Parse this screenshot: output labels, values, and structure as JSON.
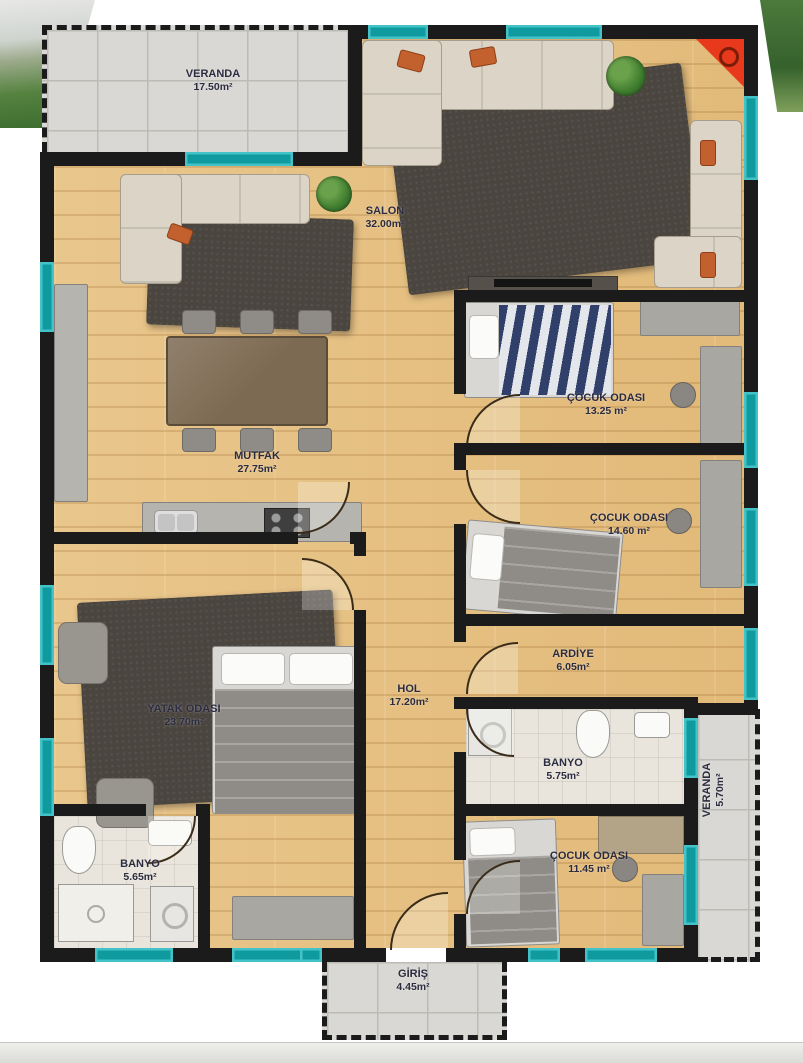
{
  "plan": {
    "rooms": [
      {
        "id": "veranda_top",
        "name": "VERANDA",
        "area": "17.50m²"
      },
      {
        "id": "salon",
        "name": "SALON",
        "area": "32.00m²"
      },
      {
        "id": "mutfak",
        "name": "MUTFAK",
        "area": "27.75m²"
      },
      {
        "id": "cocuk_odasi_1",
        "name": "ÇOCUK ODASI",
        "area": "13.25 m²"
      },
      {
        "id": "cocuk_odasi_2",
        "name": "ÇOCUK ODASI",
        "area": "14.60 m²"
      },
      {
        "id": "ardiye",
        "name": "ARDİYE",
        "area": "6.05m²"
      },
      {
        "id": "hol",
        "name": "HOL",
        "area": "17.20m²"
      },
      {
        "id": "yatak_odasi",
        "name": "YATAK ODASI",
        "area": "23.70m²"
      },
      {
        "id": "banyo_1",
        "name": "BANYO",
        "area": "5.65m²"
      },
      {
        "id": "banyo_2",
        "name": "BANYO",
        "area": "5.75m²"
      },
      {
        "id": "cocuk_odasi_3",
        "name": "ÇOCUK ODASI",
        "area": "11.45 m²"
      },
      {
        "id": "veranda_right",
        "name": "VERANDA",
        "area": "5.70m²"
      },
      {
        "id": "giris",
        "name": "GİRİŞ",
        "area": "4.45m²"
      }
    ],
    "colors": {
      "wall": "#1b1b1b",
      "window": "#0f9aa0",
      "wood_floor": "#e9c68c",
      "tile_floor": "#d9d8d4",
      "bath_floor": "#eae5dc",
      "rug": "#4b4540",
      "sofa": "#dcd5c7",
      "accent_cushion": "#c2602e",
      "corner_marker": "#e8391d",
      "label_text": "#2c2c40"
    }
  }
}
